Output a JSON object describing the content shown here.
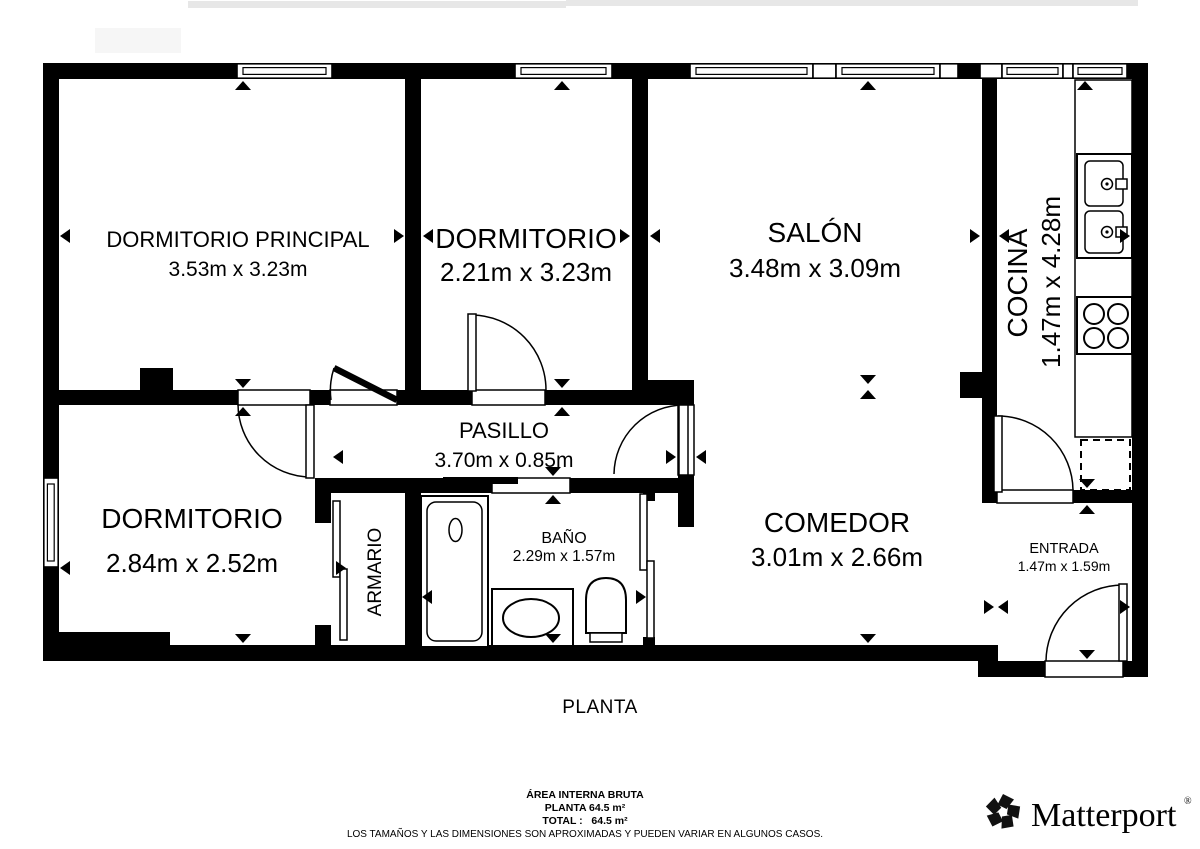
{
  "plan": {
    "title": "PLANTA",
    "rooms": [
      {
        "name": "DORMITORIO PRINCIPAL",
        "dims": "3.53m x 3.23m"
      },
      {
        "name": "DORMITORIO",
        "dims": "2.21m x 3.23m"
      },
      {
        "name": "SALÓN",
        "dims": "3.48m x 3.09m"
      },
      {
        "name": "COCINA",
        "dims": "1.47m x 4.28m"
      },
      {
        "name": "DORMITORIO",
        "dims": "2.84m x 2.52m"
      },
      {
        "name": "PASILLO",
        "dims": "3.70m x 0.85m"
      },
      {
        "name": "ARMARIO",
        "dims": ""
      },
      {
        "name": "BAÑO",
        "dims": "2.29m x 1.57m"
      },
      {
        "name": "COMEDOR",
        "dims": "3.01m x 2.66m"
      },
      {
        "name": "ENTRADA",
        "dims": "1.47m x 1.59m"
      }
    ]
  },
  "footer": {
    "area_heading": "ÁREA INTERNA BRUTA",
    "planta_area": "PLANTA 64.5 m²",
    "total_area": "TOTAL :   64.5 m²",
    "disclaimer": "LOS TAMAÑOS Y LAS DIMENSIONES SON APROXIMADAS Y PUEDEN VARIAR EN ALGUNOS CASOS."
  },
  "branding": {
    "logo_text": "Matterport",
    "registered_mark": "®"
  },
  "colors": {
    "wall": "#000000",
    "background": "#ffffff",
    "disclaimer_text": "#333333"
  }
}
